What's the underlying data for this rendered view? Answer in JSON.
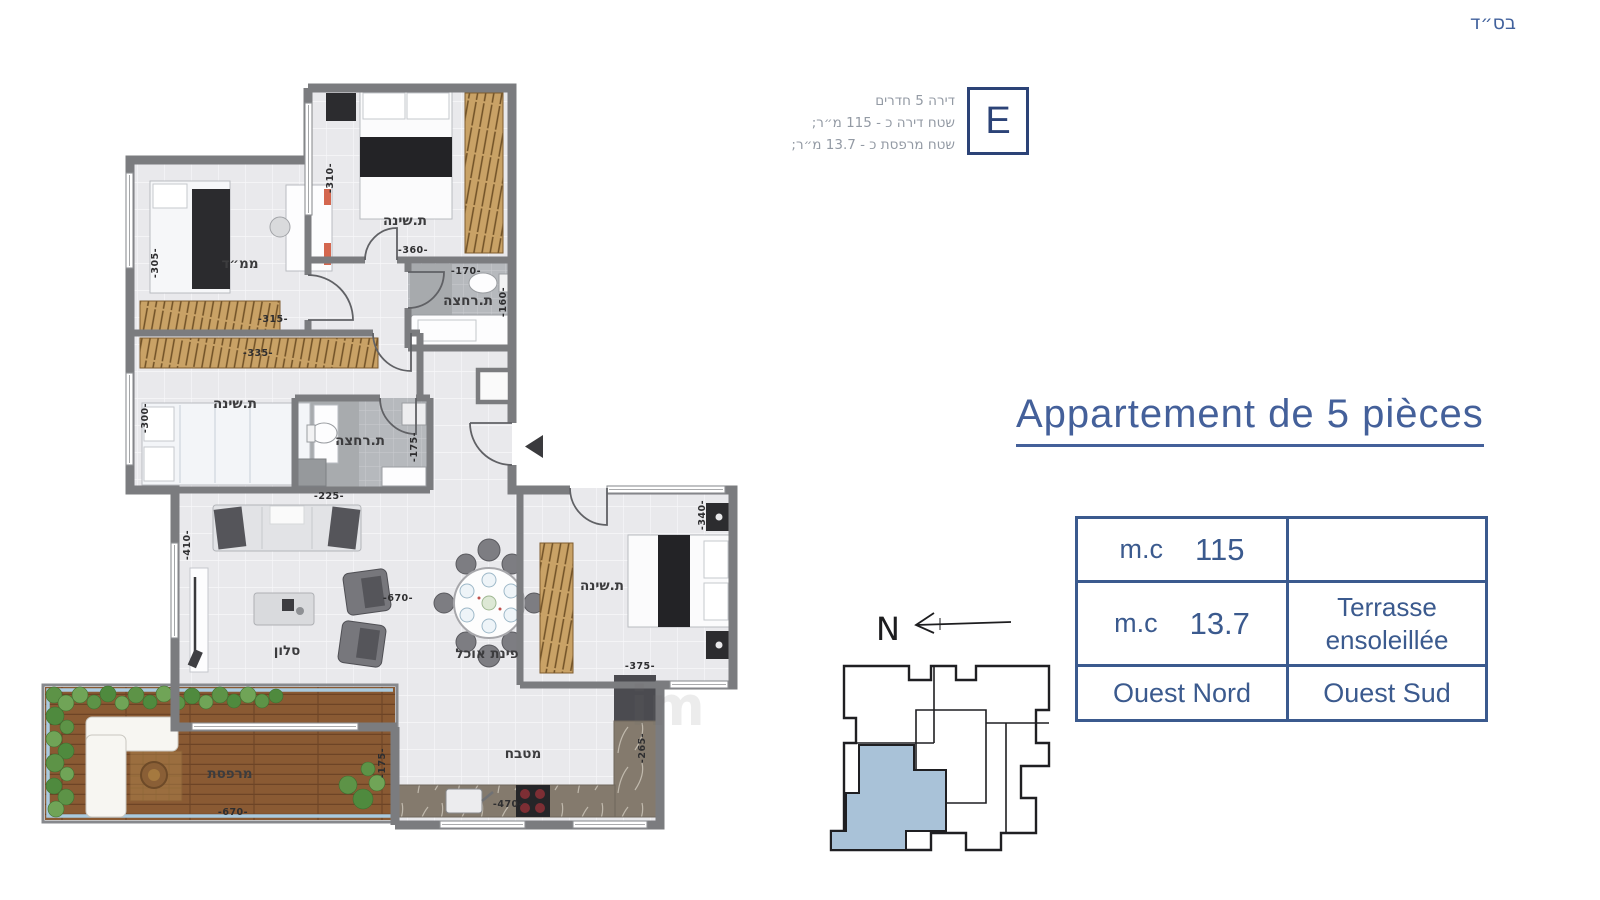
{
  "page": {
    "bsd": "בס״ד",
    "watermark": "im"
  },
  "unit_info": {
    "letter": "E",
    "line1": "דירה 5 חדרים",
    "line2": "שטח דירה כ - 115 מ״ר;",
    "line3": "שטח מרפסת כ - 13.7 מ״ר;"
  },
  "title": "Appartement de 5 pièces",
  "summary_table": {
    "r1_unit": "m.c",
    "r1_value": "115",
    "r1_right": "",
    "r2_unit": "m.c",
    "r2_value": "13.7",
    "r2_right": "Terrasse ensoleillée",
    "r3_left": "Ouest Nord",
    "r3_right": "Ouest Sud"
  },
  "compass": {
    "label": "N"
  },
  "plan": {
    "rooms": {
      "bedroom_top": "ת.שינה",
      "mamad": "ממ״ד",
      "bath_top": "ת.רחצה",
      "bedroom_mid": "ת.שינה",
      "bath_mid": "ת.רחצה",
      "salon": "סלון",
      "dining": "פינת אוכל",
      "bedroom_right": "ת.שינה",
      "kitchen": "מטבח",
      "terrace": "מרפסת"
    },
    "dims": [
      "-310-",
      "-360-",
      "-170-",
      "-160-",
      "-305-",
      "-315-",
      "-335-",
      "-300-",
      "-225-",
      "-175-",
      "-410-",
      "-670-",
      "-340-",
      "-375-",
      "-265-",
      "-470-",
      "-670-",
      "-175-"
    ]
  },
  "colors": {
    "accent": "#44609a",
    "wall": "#7b7c7f",
    "terrace_wood": "#8a5a33",
    "keyplan_highlight": "#a9c2d8"
  }
}
